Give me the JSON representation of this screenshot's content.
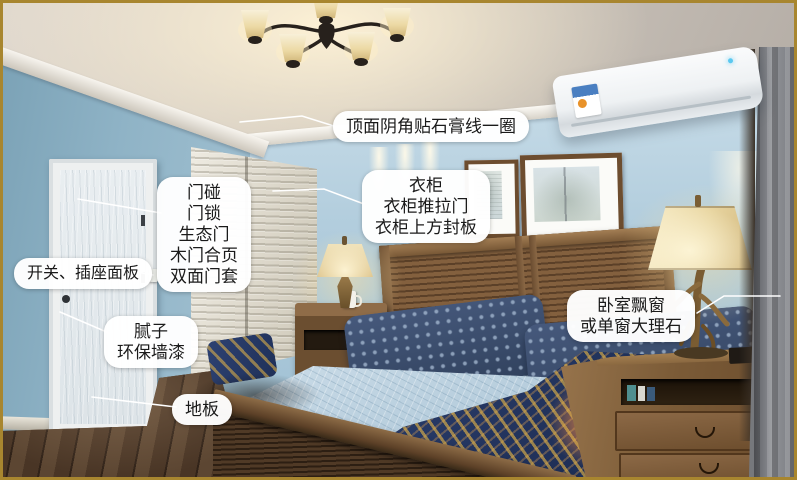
{
  "annotations": {
    "ceiling": {
      "text": "顶面阴角贴石膏线一圈"
    },
    "door": {
      "line1": "门碰",
      "line2": "门锁",
      "line3": "生态门",
      "line4": "木门合页",
      "line5": "双面门套"
    },
    "switch": {
      "text": "开关、插座面板"
    },
    "wall": {
      "line1": "腻子",
      "line2": "环保墙漆"
    },
    "floor": {
      "text": "地板"
    },
    "wardrobe": {
      "line1": "衣柜",
      "line2": "衣柜推拉门",
      "line3": "衣柜上方封板"
    },
    "window": {
      "line1": "卧室飘窗",
      "line2": "或单窗大理石"
    }
  },
  "colors": {
    "frame_border": "#a8862f",
    "label_background": "#ffffff",
    "label_text": "#1a1a1a",
    "leader_line": "#ffffff",
    "wall_blue": "#a6c4d4",
    "wood_brown": "#6b4c2c",
    "bedding_blue": "#b2cada",
    "blanket_navy": "#2e4272",
    "blanket_gold": "#d9a843",
    "lamp_shade": "#e8d5a0"
  }
}
